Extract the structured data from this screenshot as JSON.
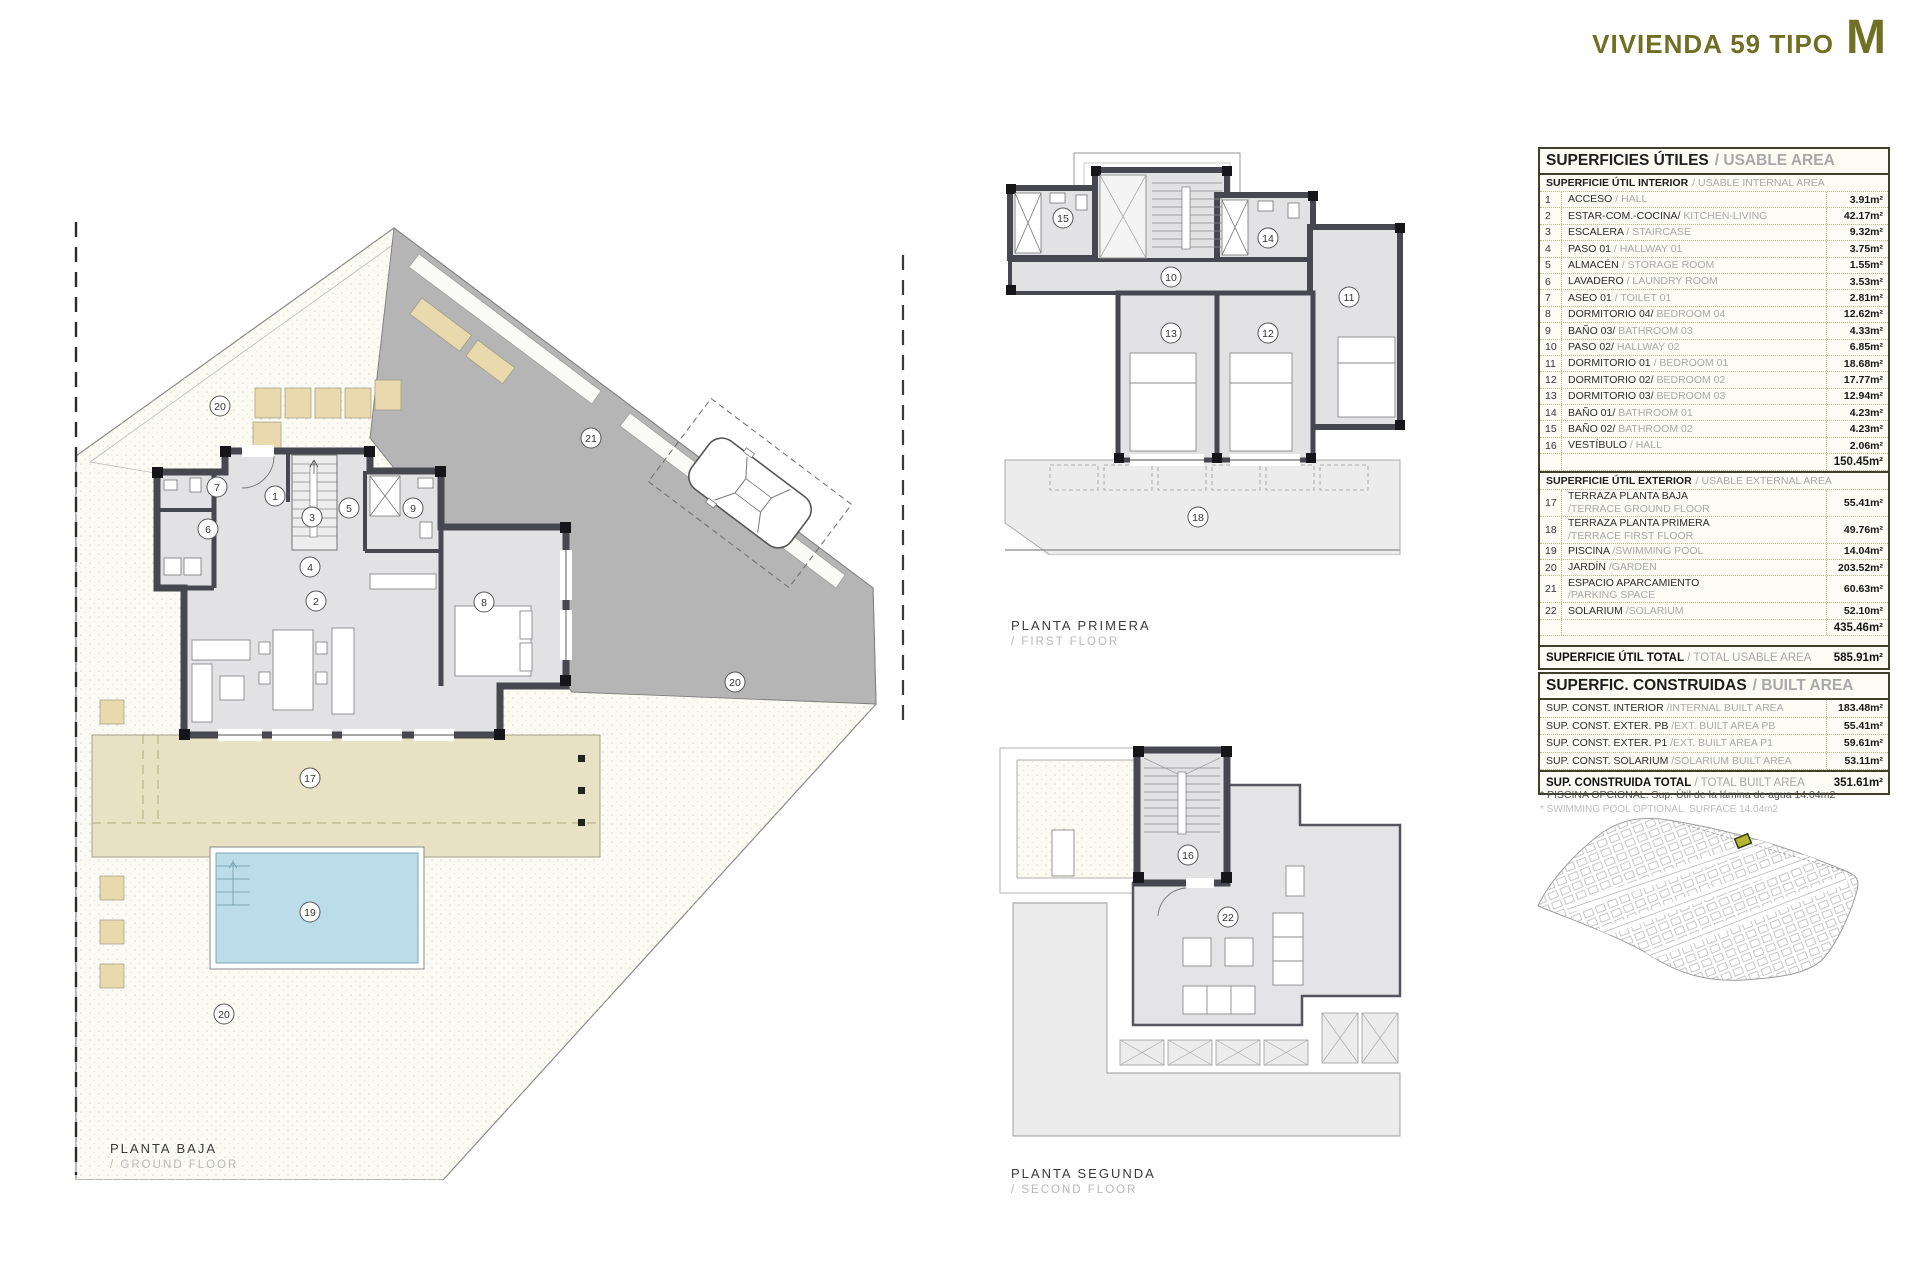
{
  "header": {
    "title": "VIVIENDA 59 TIPO",
    "type_letter": "M"
  },
  "colors": {
    "accent_olive": "#6f7024",
    "wall_dark": "#474750",
    "room_fill": "#e2e2e4",
    "driveway_gray": "#b5b5b5",
    "terrace_beige": "#e8e1c3",
    "pool_blue": "#badde9",
    "garden_cream": "#fcfbf3",
    "highlight_plot": "#b3b62f"
  },
  "floor_labels": {
    "ground": {
      "es": "PLANTA BAJA",
      "en": "/ GROUND FLOOR"
    },
    "first": {
      "es": "PLANTA PRIMERA",
      "en": "/ FIRST FLOOR"
    },
    "second": {
      "es": "PLANTA SEGUNDA",
      "en": "/ SECOND FLOOR"
    }
  },
  "plans": {
    "ground": {
      "numbers": [
        "20",
        "21",
        "20",
        "1",
        "2",
        "3",
        "4",
        "5",
        "6",
        "7",
        "8",
        "9",
        "17",
        "19",
        "20"
      ]
    },
    "first": {
      "numbers": [
        "15",
        "14",
        "10",
        "11",
        "13",
        "12",
        "18"
      ]
    },
    "second": {
      "numbers": [
        "16",
        "22"
      ]
    }
  },
  "usable_area_table": {
    "title_es": "SUPERFICIES ÚTILES",
    "title_en": "/ USABLE AREA",
    "interior_header_es": "SUPERFICIE ÚTIL INTERIOR",
    "interior_header_en": "/ USABLE INTERNAL AREA",
    "interior_rows": [
      {
        "num": "1",
        "name_es": "ACCESO",
        "name_en": "/ HALL",
        "value": "3.91m²"
      },
      {
        "num": "2",
        "name_es": "ESTAR-COM.-COCINA/",
        "name_en": " KITCHEN-LIVING",
        "value": "42.17m²"
      },
      {
        "num": "3",
        "name_es": "ESCALERA",
        "name_en": "/ STAIRCASE",
        "value": "9.32m²"
      },
      {
        "num": "4",
        "name_es": "PASO 01",
        "name_en": "/ HALLWAY  01",
        "value": "3.75m²"
      },
      {
        "num": "5",
        "name_es": "ALMACÉN",
        "name_en": "/ STORAGE ROOM",
        "value": "1.55m²"
      },
      {
        "num": "6",
        "name_es": "LAVADERO",
        "name_en": "/ LAUNDRY ROOM",
        "value": "3.53m²"
      },
      {
        "num": "7",
        "name_es": "ASEO 01",
        "name_en": "/ TOILET 01",
        "value": "2.81m²"
      },
      {
        "num": "8",
        "name_es": "DORMITORIO 04/",
        "name_en": " BEDROOM 04",
        "value": "12.62m²"
      },
      {
        "num": "9",
        "name_es": "BAÑO 03/",
        "name_en": " BATHROOM 03",
        "value": "4.33m²"
      },
      {
        "num": "10",
        "name_es": "PASO 02/",
        "name_en": " HALLWAY 02",
        "value": "6.85m²"
      },
      {
        "num": "11",
        "name_es": "DORMITORIO 01",
        "name_en": "/ BEDROOM 01",
        "value": "18.68m²"
      },
      {
        "num": "12",
        "name_es": "DORMITORIO 02/",
        "name_en": " BEDROOM 02",
        "value": "17.77m²"
      },
      {
        "num": "13",
        "name_es": "DORMITORIO 03/",
        "name_en": " BEDROOM 03",
        "value": "12.94m²"
      },
      {
        "num": "14",
        "name_es": "BAÑO 01/",
        "name_en": " BATHROOM 01",
        "value": "4.23m²"
      },
      {
        "num": "15",
        "name_es": "BAÑO 02/",
        "name_en": " BATHROOM 02",
        "value": "4.23m²"
      },
      {
        "num": "16",
        "name_es": "VESTÍBULO",
        "name_en": "/ HALL",
        "value": "2.06m²"
      }
    ],
    "interior_subtotal": "150.45m²",
    "exterior_header_es": "SUPERFICIE ÚTIL EXTERIOR",
    "exterior_header_en": "/ USABLE EXTERNAL AREA",
    "exterior_rows": [
      {
        "num": "17",
        "name_es": "TERRAZA PLANTA BAJA",
        "name_en": "/TERRACE GROUND FLOOR",
        "value": "55.41m²"
      },
      {
        "num": "18",
        "name_es": "TERRAZA PLANTA PRIMERA",
        "name_en": "/TERRACE FIRST FLOOR",
        "value": "49.76m²"
      },
      {
        "num": "19",
        "name_es": "PISCINA",
        "name_en": "/SWIMMING POOL",
        "value": "14.04m²"
      },
      {
        "num": "20",
        "name_es": "JARDÍN",
        "name_en": "/GARDEN",
        "value": "203.52m²"
      },
      {
        "num": "21",
        "name_es": "ESPACIO APARCAMIENTO",
        "name_en": "/PARKING SPACE",
        "value": "60.63m²"
      },
      {
        "num": "22",
        "name_es": "SOLARIUM",
        "name_en": "/SOLARIUM",
        "value": "52.10m²"
      }
    ],
    "exterior_subtotal": "435.46m²",
    "total_label_es": "SUPERFICIE ÚTIL TOTAL",
    "total_label_en": "/ TOTAL USABLE AREA",
    "total_value": "585.91m²"
  },
  "built_area_table": {
    "title_es": "SUPERFIC. CONSTRUIDAS",
    "title_en": "/ BUILT AREA",
    "rows": [
      {
        "name_es": "SUP. CONST. INTERIOR",
        "name_en": "/INTERNAL BUILT AREA",
        "value": "183.48m²"
      },
      {
        "name_es": "SUP. CONST. EXTER. PB",
        "name_en": "/EXT. BUILT AREA PB",
        "value": "55.41m²"
      },
      {
        "name_es": "SUP. CONST. EXTER. P1",
        "name_en": "/EXT. BUILT AREA P1",
        "value": "59.61m²"
      },
      {
        "name_es": "SUP. CONST. SOLARIUM",
        "name_en": "/SOLARIUM BUILT AREA",
        "value": "53.11m²"
      }
    ],
    "total_label_es": "SUP. CONSTRUIDA TOTAL",
    "total_label_en": "/ TOTAL BUILT AREA",
    "total_value": "351.61m²"
  },
  "footnotes": {
    "line1": "* PISCINA OPCIONAL. Sup. Útil de la lámina de agua 14.04m2",
    "line2": "* SWIMMING POOL OPTIONAL. SURFACE 14.04m2"
  }
}
